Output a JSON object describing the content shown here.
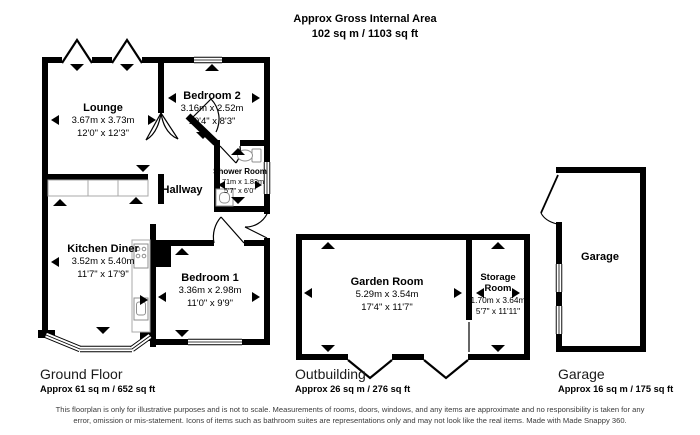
{
  "header": {
    "line1": "Approx Gross Internal Area",
    "line2": "102 sq m / 1103 sq ft"
  },
  "rooms": {
    "lounge": {
      "name": "Lounge",
      "metric": "3.67m x 3.73m",
      "imperial": "12'0\" x 12'3\""
    },
    "bedroom2": {
      "name": "Bedroom 2",
      "metric": "3.16m x 2.52m",
      "imperial": "10'4\" x 8'3\""
    },
    "shower": {
      "name": "Shower Room",
      "metric": "1.71m x 1.83m",
      "imperial": "5'7\" x 6'0\""
    },
    "hallway": {
      "name": "Hallway"
    },
    "kitchen": {
      "name": "Kitchen Diner",
      "metric": "3.52m x 5.40m",
      "imperial": "11'7\" x 17'9\""
    },
    "bedroom1": {
      "name": "Bedroom 1",
      "metric": "3.36m x 2.98m",
      "imperial": "11'0\" x 9'9\""
    },
    "garden_room": {
      "name": "Garden Room",
      "metric": "5.29m x 3.54m",
      "imperial": "17'4\" x 11'7\""
    },
    "storage": {
      "name": "Storage Room",
      "metric": "1.70m x 3.64m",
      "imperial": "5'7\" x 11'11\""
    },
    "garage": {
      "name": "Garage"
    }
  },
  "sections": {
    "ground_floor": {
      "title": "Ground Floor",
      "area": "Approx 61 sq m / 652 sq ft"
    },
    "outbuilding": {
      "title": "Outbuilding",
      "area": "Approx 26 sq m / 276 sq ft"
    },
    "garage": {
      "title": "Garage",
      "area": "Approx 16 sq m / 175 sq ft"
    }
  },
  "disclaimer": "This floorplan is only for illustrative purposes and is not to scale. Measurements of rooms, doors, windows, and any items are approximate and no responsibility is taken for any error, omission or mis-statement. Icons of items such as bathroom suites are representations only and may not look like the real items. Made with Made Snappy 360.",
  "colors": {
    "wall": "#000000",
    "fixture": "#8f8f8f",
    "counter": "#a8a8a8"
  }
}
